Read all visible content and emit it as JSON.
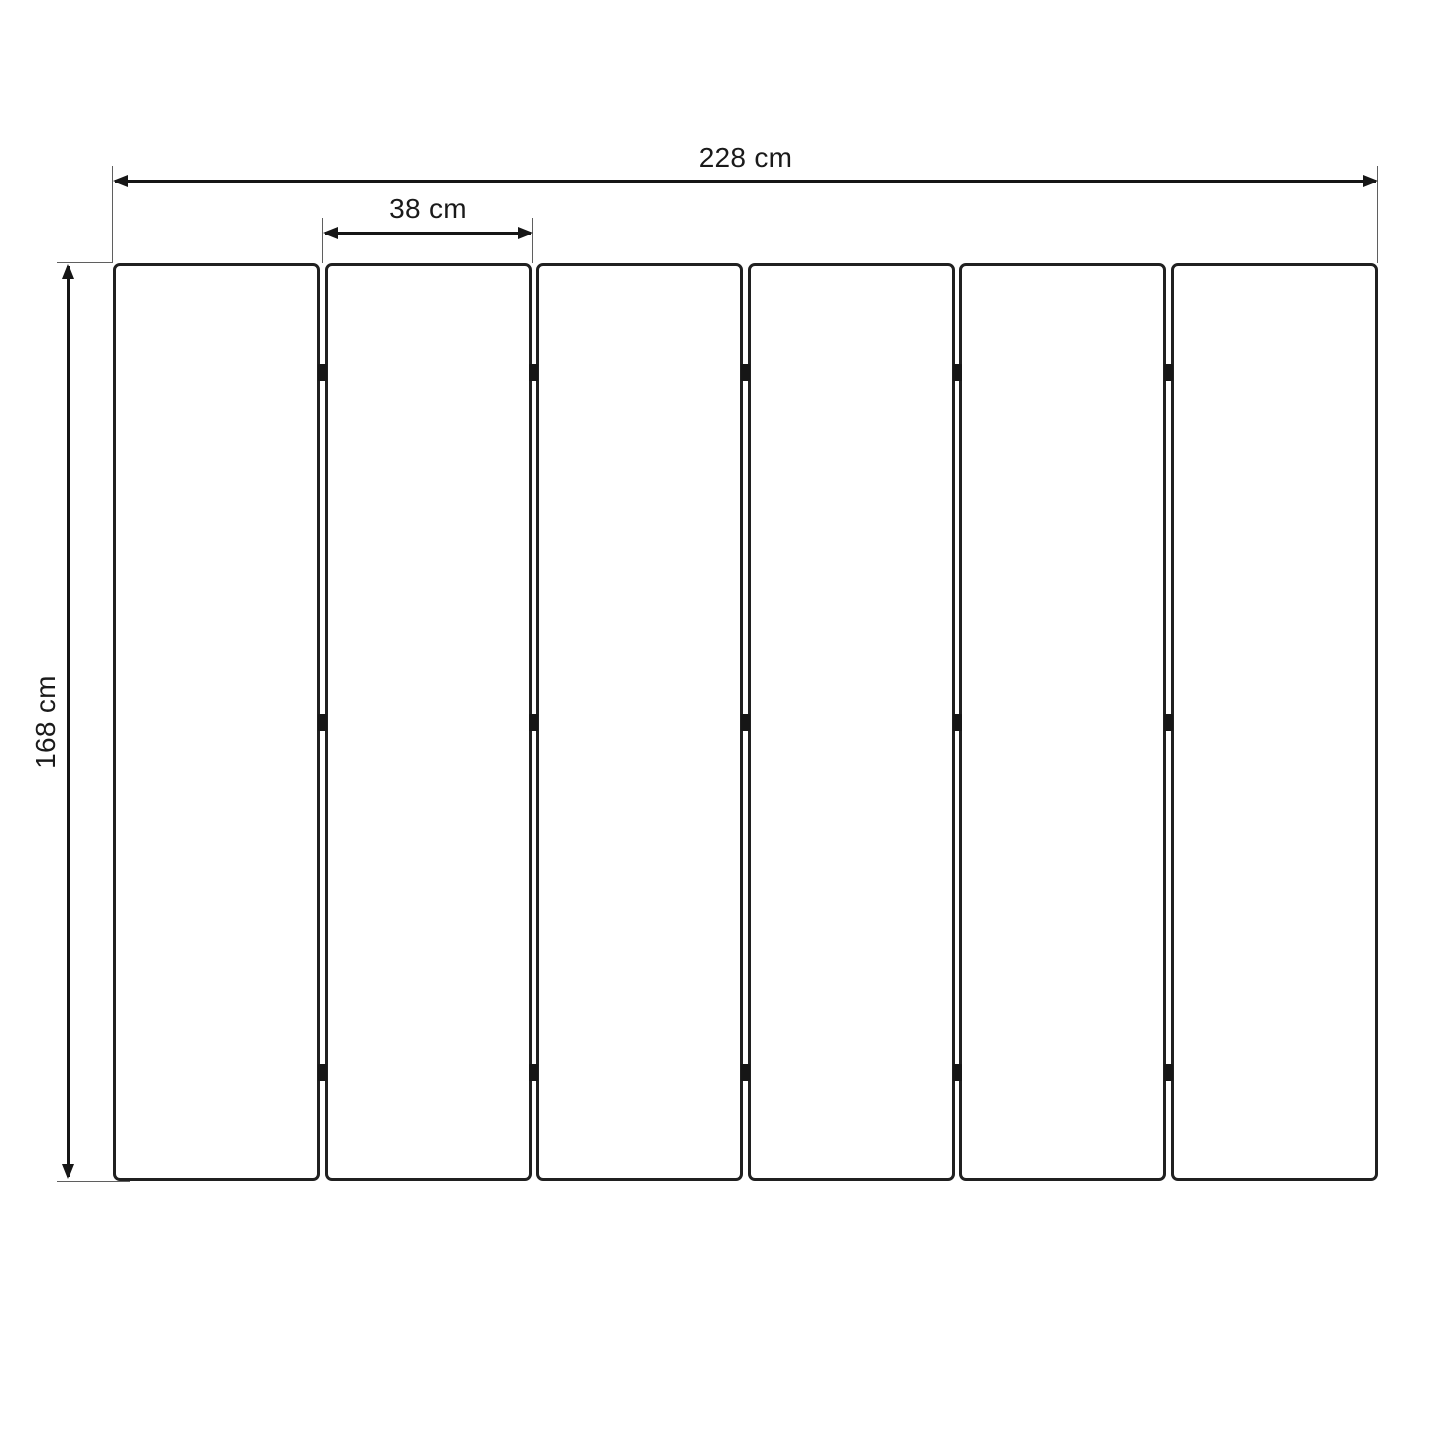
{
  "diagram": {
    "title": "folding-screen-panel-dimension-diagram",
    "colors": {
      "background": "#ffffff",
      "dimension_line": "#161616",
      "extension_line": "#5f5f5f",
      "panel_border": "#202020",
      "panel_fill": "#ffffff",
      "hinge": "#161616",
      "text": "#1a1a1a"
    },
    "dimensions": {
      "total_width": {
        "label": "228 cm",
        "value": 228,
        "unit": "cm"
      },
      "panel_width": {
        "label": "38 cm",
        "value": 38,
        "unit": "cm"
      },
      "height": {
        "label": "168 cm",
        "value": 168,
        "unit": "cm"
      }
    },
    "panels": {
      "count": 6,
      "gaps": 5,
      "hinge_rows_per_gap": 3
    }
  }
}
